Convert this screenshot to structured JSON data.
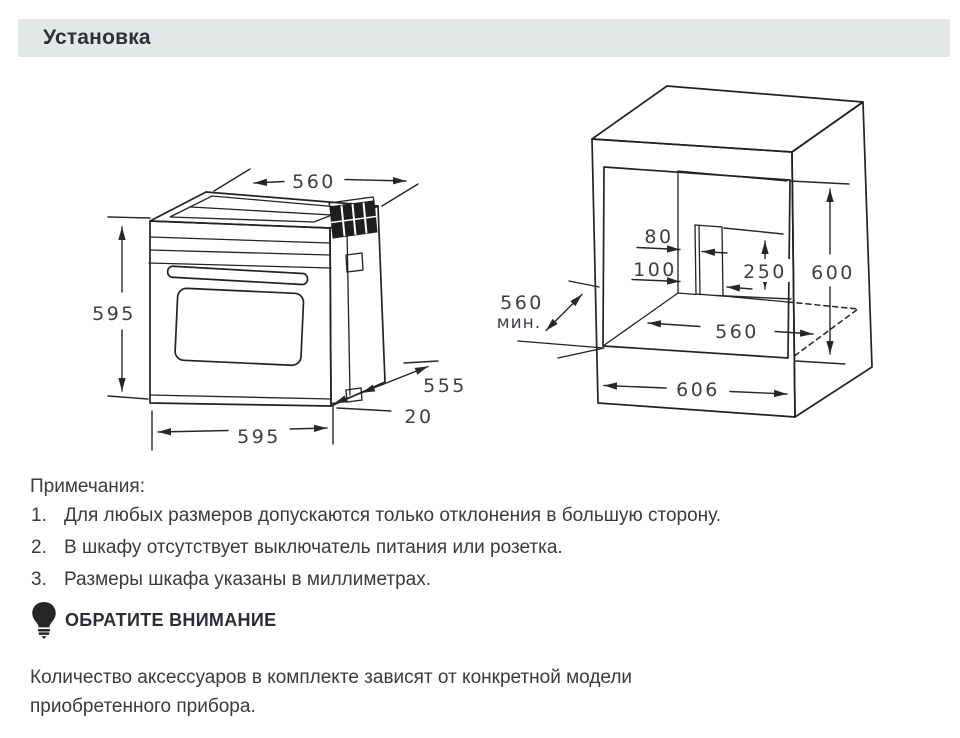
{
  "page": {
    "title": "Установка"
  },
  "notes": {
    "heading": "Примечания:",
    "items": [
      {
        "num": "1.",
        "text": "Для любых размеров допускаются только отклонения в большую сторону."
      },
      {
        "num": "2.",
        "text": "В шкафу отсутствует выключатель питания или розетка."
      },
      {
        "num": "3.",
        "text": "Размеры шкафа указаны в миллиметрах."
      }
    ]
  },
  "attention": {
    "heading": "ОБРАТИТЕ ВНИМАНИЕ",
    "icon": "lightbulb-icon",
    "body_lines": [
      "Количество аксессуаров в комплекте зависят от конкретной модели",
      "приобретенного прибора."
    ]
  },
  "oven_diagram": {
    "dims": {
      "top_depth": "560",
      "height": "595",
      "side_depth": "555",
      "front_overhang": "20",
      "width": "595"
    }
  },
  "cabinet_diagram": {
    "dims": {
      "cutout_offset_upper": "80",
      "cutout_offset_lower": "100",
      "cutout_height": "250",
      "niche_height": "600",
      "min_depth": "560",
      "min_depth_unit": "мин.",
      "niche_width": "560",
      "outer_width": "606"
    }
  },
  "colors": {
    "header_bar_bg": "#e4e7e7",
    "header_text": "#2d3237",
    "body_text": "#3a3a3a",
    "line_art": "#222222",
    "dim_text": "#3a4046"
  }
}
